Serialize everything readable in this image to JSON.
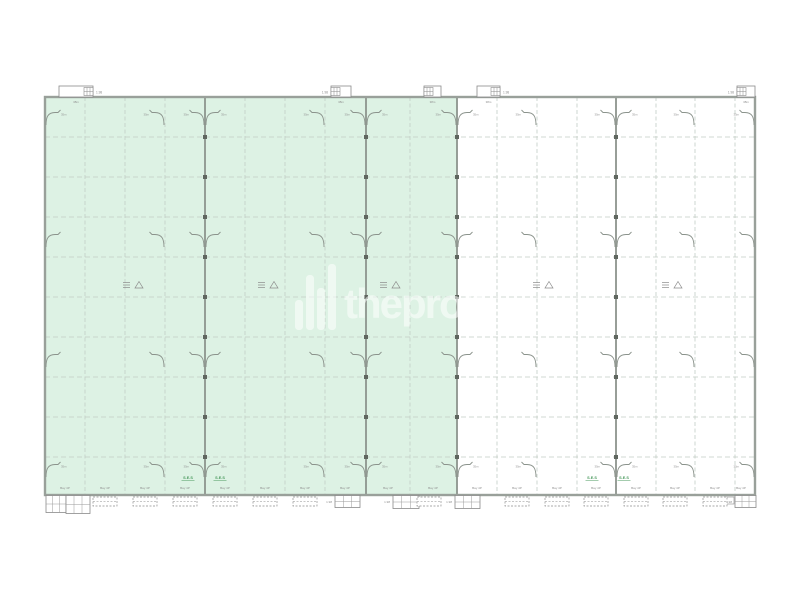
{
  "colors": {
    "highlight_green": "#ddf2e4",
    "grid_light": "#c2cdc5",
    "grid_heavy": "#8d948d",
    "wall": "#99a09a",
    "column_marker": "#5f665f",
    "tiny_label": "#8f8f8f",
    "ses_green": "#4a9a5e",
    "dock_dash": "#8f8f8f",
    "watermark_white": "#ffffff"
  },
  "plan": {
    "x": 45,
    "y": 97,
    "w": 710,
    "h": 398,
    "green_w": 412
  },
  "grid": {
    "light_cols": [
      85,
      125,
      165,
      245,
      285,
      325,
      410,
      497,
      537,
      577,
      656,
      695,
      735
    ],
    "heavy_cols": [
      205,
      366,
      457,
      616
    ],
    "rows": [
      137,
      177,
      217,
      257,
      297,
      337,
      377,
      417,
      457
    ]
  },
  "curves": {
    "rows": [
      110,
      232,
      352,
      462
    ],
    "cols": [
      {
        "x": 45,
        "side": "r"
      },
      {
        "x": 165,
        "side": "l"
      },
      {
        "x": 205,
        "side": "b"
      },
      {
        "x": 325,
        "side": "l"
      },
      {
        "x": 366,
        "side": "b"
      },
      {
        "x": 457,
        "side": "b"
      },
      {
        "x": 537,
        "side": "l"
      },
      {
        "x": 616,
        "side": "b"
      },
      {
        "x": 695,
        "side": "l"
      },
      {
        "x": 755,
        "side": "l"
      }
    ],
    "label": "35m",
    "label_rows": [
      0,
      3
    ]
  },
  "vents": {
    "y": 285,
    "xs": [
      133,
      268,
      390,
      543,
      672
    ]
  },
  "top_blocks": [
    {
      "x": 59,
      "w": 34,
      "label": "1.98",
      "label_side": "r",
      "sub": "r",
      "under": "38m"
    },
    {
      "x": 331,
      "w": 20,
      "label": "1.98",
      "label_side": "l",
      "sub": "l",
      "under": "38m"
    },
    {
      "x": 424,
      "w": 17,
      "label": "",
      "label_side": "l",
      "sub": "l",
      "under": "38m"
    },
    {
      "x": 477,
      "w": 23,
      "label": "1.98",
      "label_side": "r",
      "sub": "r",
      "under": "38m"
    },
    {
      "x": 737,
      "w": 18,
      "label": "1.98",
      "label_side": "l",
      "sub": "l",
      "under": "38m"
    }
  ],
  "bottom_blocks": [
    {
      "x": 46,
      "w": 20,
      "h": 17,
      "label": "",
      "sub": false
    },
    {
      "x": 66,
      "w": 24,
      "h": 18,
      "label": "",
      "sub": false
    },
    {
      "x": 335,
      "w": 25,
      "h": 12,
      "label": "1.98",
      "sub": false
    },
    {
      "x": 393,
      "w": 26,
      "h": 13,
      "label": "1.98",
      "sub": false
    },
    {
      "x": 455,
      "w": 25,
      "h": 13,
      "label": "1.98",
      "sub": false
    },
    {
      "x": 735,
      "w": 21,
      "h": 12,
      "label": "1.98",
      "sub": true
    }
  ],
  "docks": {
    "y": 497,
    "w": 24,
    "h": 9,
    "centers": [
      105,
      145,
      185,
      225,
      265,
      305,
      429,
      517,
      557,
      596,
      636,
      675,
      715
    ]
  },
  "bay_labels": {
    "text": "Bay 4P",
    "y": 489,
    "centers": [
      65,
      105,
      145,
      185,
      225,
      265,
      305,
      345,
      388,
      433,
      477,
      517,
      557,
      596,
      636,
      675,
      715,
      741
    ]
  },
  "ses_labels": {
    "text": "S.E.S",
    "y": 479,
    "xs": [
      188,
      220,
      592,
      624
    ]
  },
  "watermark": {
    "text": "theprop",
    "opacity": 0.55,
    "bars": [
      {
        "x": 295,
        "h": 30
      },
      {
        "x": 306,
        "h": 55
      },
      {
        "x": 317,
        "h": 42
      },
      {
        "x": 328,
        "h": 66
      }
    ],
    "bar_w": 8,
    "bar_bottom": 330,
    "text_x": 344,
    "text_y": 318
  }
}
